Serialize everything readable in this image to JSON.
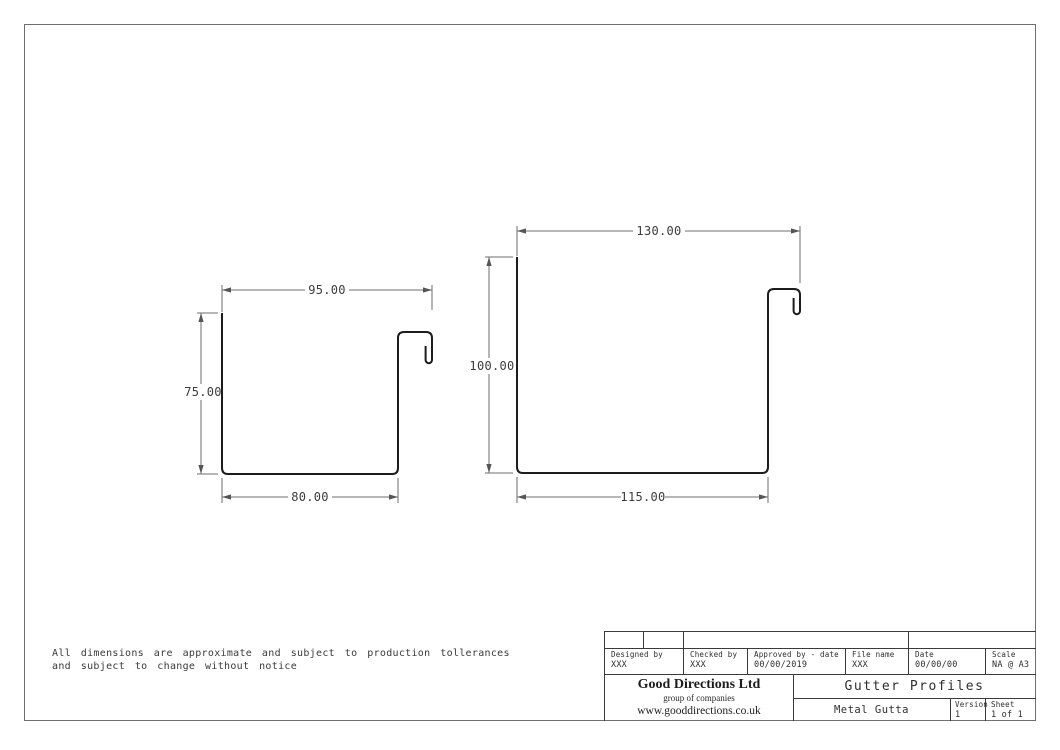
{
  "profiles": {
    "left": {
      "top_width": "95.00",
      "height": "75.00",
      "bottom_width": "80.00"
    },
    "right": {
      "top_width": "130.00",
      "height": "100.00",
      "bottom_width": "115.00"
    }
  },
  "disclaimer": {
    "line1": "All dimensions are approximate and subject to production tollerances",
    "line2": "and subject to change without notice"
  },
  "title_block": {
    "designed_by": {
      "label": "Designed by",
      "value": "XXX"
    },
    "checked_by": {
      "label": "Checked by",
      "value": "XXX"
    },
    "approved_by": {
      "label": "Approved by - date",
      "value": "00/00/2019"
    },
    "file_name": {
      "label": "File name",
      "value": "XXX"
    },
    "date": {
      "label": "Date",
      "value": "00/00/00"
    },
    "scale": {
      "label": "Scale",
      "value": "NA @ A3"
    },
    "company_name": "Good Directions Ltd",
    "company_tagline": "group of companies",
    "company_website": "www.gooddirections.co.uk",
    "drawing_title": "Gutter Profiles",
    "drawing_subtitle": "Metal Gutta",
    "version": {
      "label": "Version",
      "value": "1"
    },
    "sheet": {
      "label": "Sheet",
      "value": "1 of 1"
    }
  },
  "colors": {
    "profile_line": "#1c1c1c",
    "dimension_line": "#6e6e6e",
    "table_line": "#3a3a3a",
    "page_border": "#6f6f6f"
  }
}
